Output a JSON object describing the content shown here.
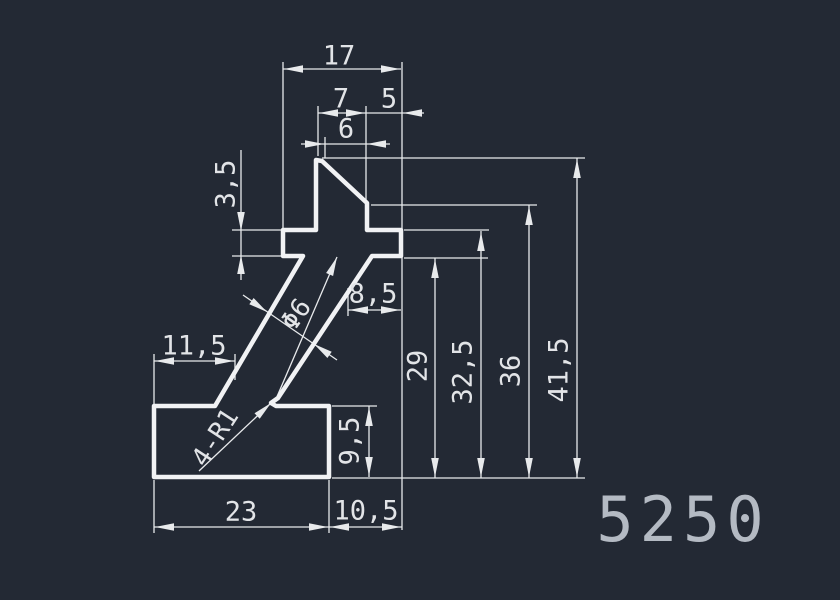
{
  "drawing": {
    "title": "5250",
    "canvas": {
      "width": 840,
      "height": 600
    },
    "colors": {
      "background": "#232934",
      "profile_stroke": "#f1f2f4",
      "dim_stroke": "#e8eaec",
      "dim_text": "#e2e4e7",
      "title_text": "#b4bac3"
    },
    "profile": {
      "name": "extrusion-profile-outline",
      "points": "316,160 322,161 367,203 367,230 401,230 401,256 372,256 278,398 271,403 276,406 329,406 329,477 154,477 154,406 215,406 303,256 283,256 283,230 316,230",
      "stroke_width": 4.5
    },
    "thin_lines": [
      [
        283,
        62,
        283,
        228
      ],
      [
        402,
        62,
        402,
        530
      ],
      [
        318,
        106,
        318,
        156
      ],
      [
        366,
        106,
        366,
        200
      ],
      [
        325,
        137,
        325,
        158
      ],
      [
        348,
        288,
        348,
        316
      ],
      [
        232,
        230,
        281,
        230
      ],
      [
        232,
        256,
        281,
        256
      ],
      [
        241,
        150,
        241,
        280
      ],
      [
        154,
        354,
        154,
        404
      ],
      [
        235,
        354,
        235,
        380
      ],
      [
        332,
        406,
        377,
        406
      ],
      [
        404,
        258,
        488,
        258
      ],
      [
        404,
        230,
        489,
        230
      ],
      [
        371,
        205,
        537,
        205
      ],
      [
        322,
        158,
        585,
        158
      ],
      [
        332,
        478,
        585,
        478
      ],
      [
        154,
        480,
        154,
        533
      ],
      [
        329,
        480,
        329,
        533
      ],
      [
        283,
        69,
        401,
        69
      ],
      [
        318,
        113,
        424,
        113
      ],
      [
        301,
        144,
        390,
        144
      ],
      [
        348,
        310,
        401,
        310
      ],
      [
        154,
        361,
        235,
        361
      ],
      [
        154,
        527,
        329,
        527
      ],
      [
        329,
        527,
        402,
        527
      ],
      [
        369,
        406,
        369,
        477
      ],
      [
        435,
        258,
        435,
        478
      ],
      [
        481,
        231,
        481,
        478
      ],
      [
        529,
        205,
        529,
        478
      ],
      [
        577,
        158,
        577,
        478
      ],
      [
        199,
        471,
        271,
        403
      ],
      [
        276,
        399,
        337,
        257
      ],
      [
        243,
        295,
        337,
        360
      ]
    ],
    "arrows": [
      {
        "x": 284,
        "y": 69,
        "dir": 180
      },
      {
        "x": 400,
        "y": 69,
        "dir": 0
      },
      {
        "x": 319,
        "y": 113,
        "dir": 180
      },
      {
        "x": 365,
        "y": 113,
        "dir": 0
      },
      {
        "x": 403,
        "y": 113,
        "dir": 180
      },
      {
        "x": 324,
        "y": 144,
        "dir": 0
      },
      {
        "x": 367,
        "y": 144,
        "dir": 180
      },
      {
        "x": 349,
        "y": 310,
        "dir": 180
      },
      {
        "x": 400,
        "y": 310,
        "dir": 0
      },
      {
        "x": 155,
        "y": 361,
        "dir": 180
      },
      {
        "x": 234,
        "y": 361,
        "dir": 0
      },
      {
        "x": 155,
        "y": 527,
        "dir": 180
      },
      {
        "x": 328,
        "y": 527,
        "dir": 0
      },
      {
        "x": 330,
        "y": 527,
        "dir": 180
      },
      {
        "x": 401,
        "y": 527,
        "dir": 0
      },
      {
        "x": 241,
        "y": 231,
        "dir": 90
      },
      {
        "x": 241,
        "y": 255,
        "dir": 270
      },
      {
        "x": 369,
        "y": 407,
        "dir": 270
      },
      {
        "x": 369,
        "y": 476,
        "dir": 90
      },
      {
        "x": 435,
        "y": 259,
        "dir": 270
      },
      {
        "x": 435,
        "y": 477,
        "dir": 90
      },
      {
        "x": 481,
        "y": 232,
        "dir": 270
      },
      {
        "x": 481,
        "y": 477,
        "dir": 90
      },
      {
        "x": 529,
        "y": 206,
        "dir": 270
      },
      {
        "x": 529,
        "y": 477,
        "dir": 90
      },
      {
        "x": 577,
        "y": 159,
        "dir": 270
      },
      {
        "x": 577,
        "y": 477,
        "dir": 90
      },
      {
        "x": 271,
        "y": 403,
        "dir": -43
      },
      {
        "x": 337,
        "y": 257,
        "dir": -67
      },
      {
        "x": 267,
        "y": 312,
        "dir": 35
      },
      {
        "x": 314,
        "y": 344,
        "dir": 215
      }
    ],
    "dim_labels": [
      {
        "id": "dim-17",
        "text": "17",
        "x": 339,
        "y": 57,
        "rot": 0,
        "size": 27
      },
      {
        "id": "dim-7",
        "text": "7",
        "x": 341,
        "y": 100,
        "rot": 0,
        "size": 27
      },
      {
        "id": "dim-5",
        "text": "5",
        "x": 389,
        "y": 100,
        "rot": 0,
        "size": 27
      },
      {
        "id": "dim-6",
        "text": "6",
        "x": 346,
        "y": 130,
        "rot": 0,
        "size": 27
      },
      {
        "id": "dim-3-5",
        "text": "3,5",
        "x": 227,
        "y": 184,
        "rot": -90,
        "size": 27
      },
      {
        "id": "dim-8-5",
        "text": "8,5",
        "x": 373,
        "y": 295,
        "rot": 0,
        "size": 27
      },
      {
        "id": "dim-11-5",
        "text": "11,5",
        "x": 194,
        "y": 347,
        "rot": 0,
        "size": 27
      },
      {
        "id": "dim-9-5",
        "text": "9,5",
        "x": 351,
        "y": 441,
        "rot": -90,
        "size": 27
      },
      {
        "id": "dim-29",
        "text": "29",
        "x": 419,
        "y": 366,
        "rot": -90,
        "size": 27
      },
      {
        "id": "dim-32-5",
        "text": "32,5",
        "x": 464,
        "y": 372,
        "rot": -90,
        "size": 27
      },
      {
        "id": "dim-36",
        "text": "36",
        "x": 512,
        "y": 371,
        "rot": -90,
        "size": 27
      },
      {
        "id": "dim-41-5",
        "text": "41,5",
        "x": 560,
        "y": 370,
        "rot": -90,
        "size": 27
      },
      {
        "id": "dim-23",
        "text": "23",
        "x": 241,
        "y": 513,
        "rot": 0,
        "size": 27
      },
      {
        "id": "dim-10-5",
        "text": "10,5",
        "x": 366,
        "y": 512,
        "rot": 0,
        "size": 27
      },
      {
        "id": "dim-dia-6",
        "text": "Φ6",
        "x": 297,
        "y": 315,
        "rot": -55,
        "size": 26
      },
      {
        "id": "dim-4-r1",
        "text": "4-R1",
        "x": 216,
        "y": 438,
        "rot": -57,
        "size": 26
      }
    ]
  }
}
